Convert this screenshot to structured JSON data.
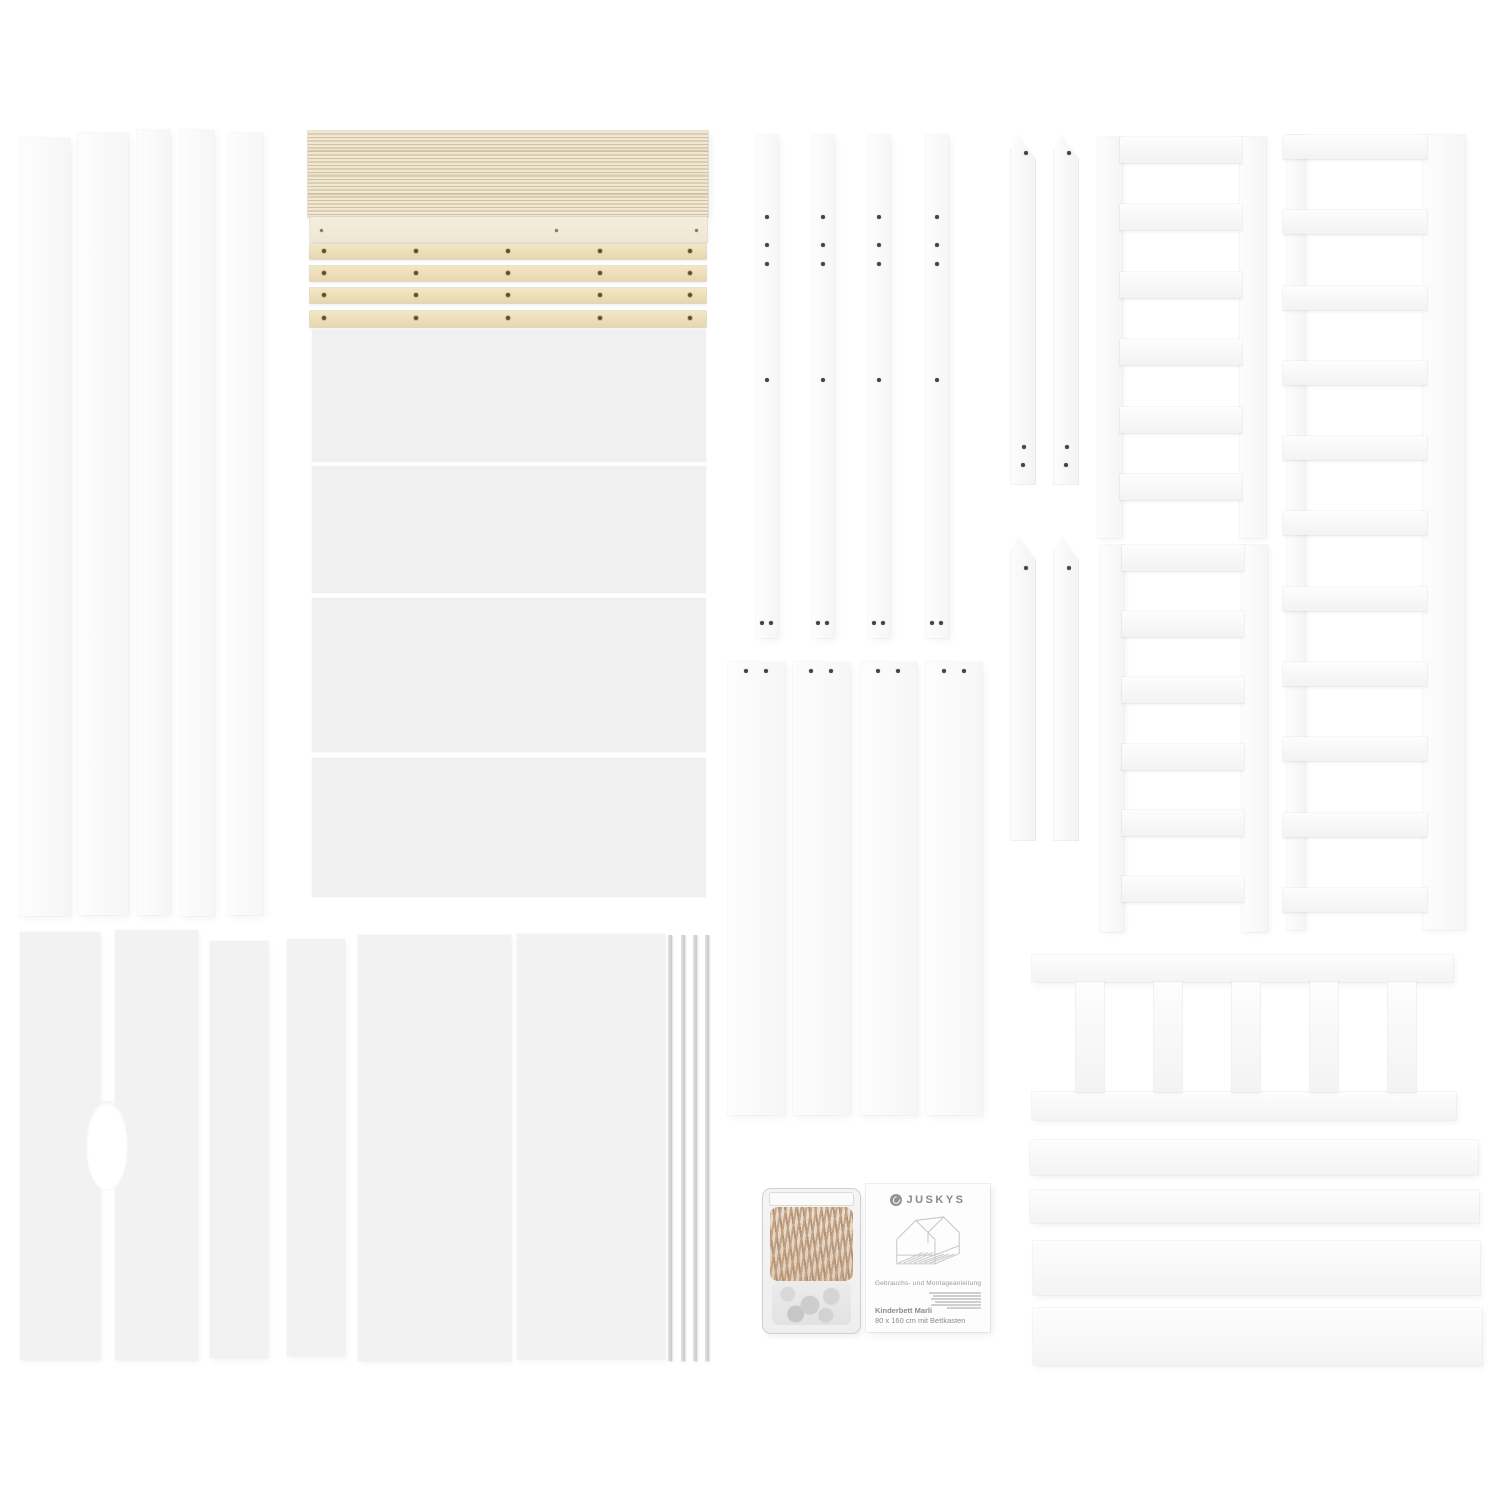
{
  "photo": {
    "description_colors": {
      "background": "#ffffff",
      "white_parts": "#f7f7f7",
      "gray_panels": "#f0f0f0",
      "plywood": "#e9ddc0",
      "plywood_stripe": "#cfc1a0",
      "pine_rail": "#eedfb6",
      "metal_rod": "#d8d8d8",
      "screws": "#c2a284",
      "manual_text": "#8f8f8f"
    },
    "parts_inventory": {
      "tall_side_boards": 5,
      "slat_stack_bundles": 1,
      "slat_support_rails": 4,
      "large_side_panels": 4,
      "drilled_bed_posts": 4,
      "pointed_roof_posts": 4,
      "slatted_ladder_panels": 3,
      "guard_rail_with_slats": 1,
      "mid_drawer_boards": 4,
      "bottom_left_panels": 4,
      "large_bottom_panels": 2,
      "metal_rods": 4,
      "hardware_bags": 1,
      "instruction_manuals": 1
    }
  },
  "manual": {
    "brand": "JUSKYS",
    "title": "Gebrauchs- und Montageanleitung",
    "product_name": "Kinderbett Marli",
    "product_size": "80 x 160 cm mit Bettkasten"
  }
}
